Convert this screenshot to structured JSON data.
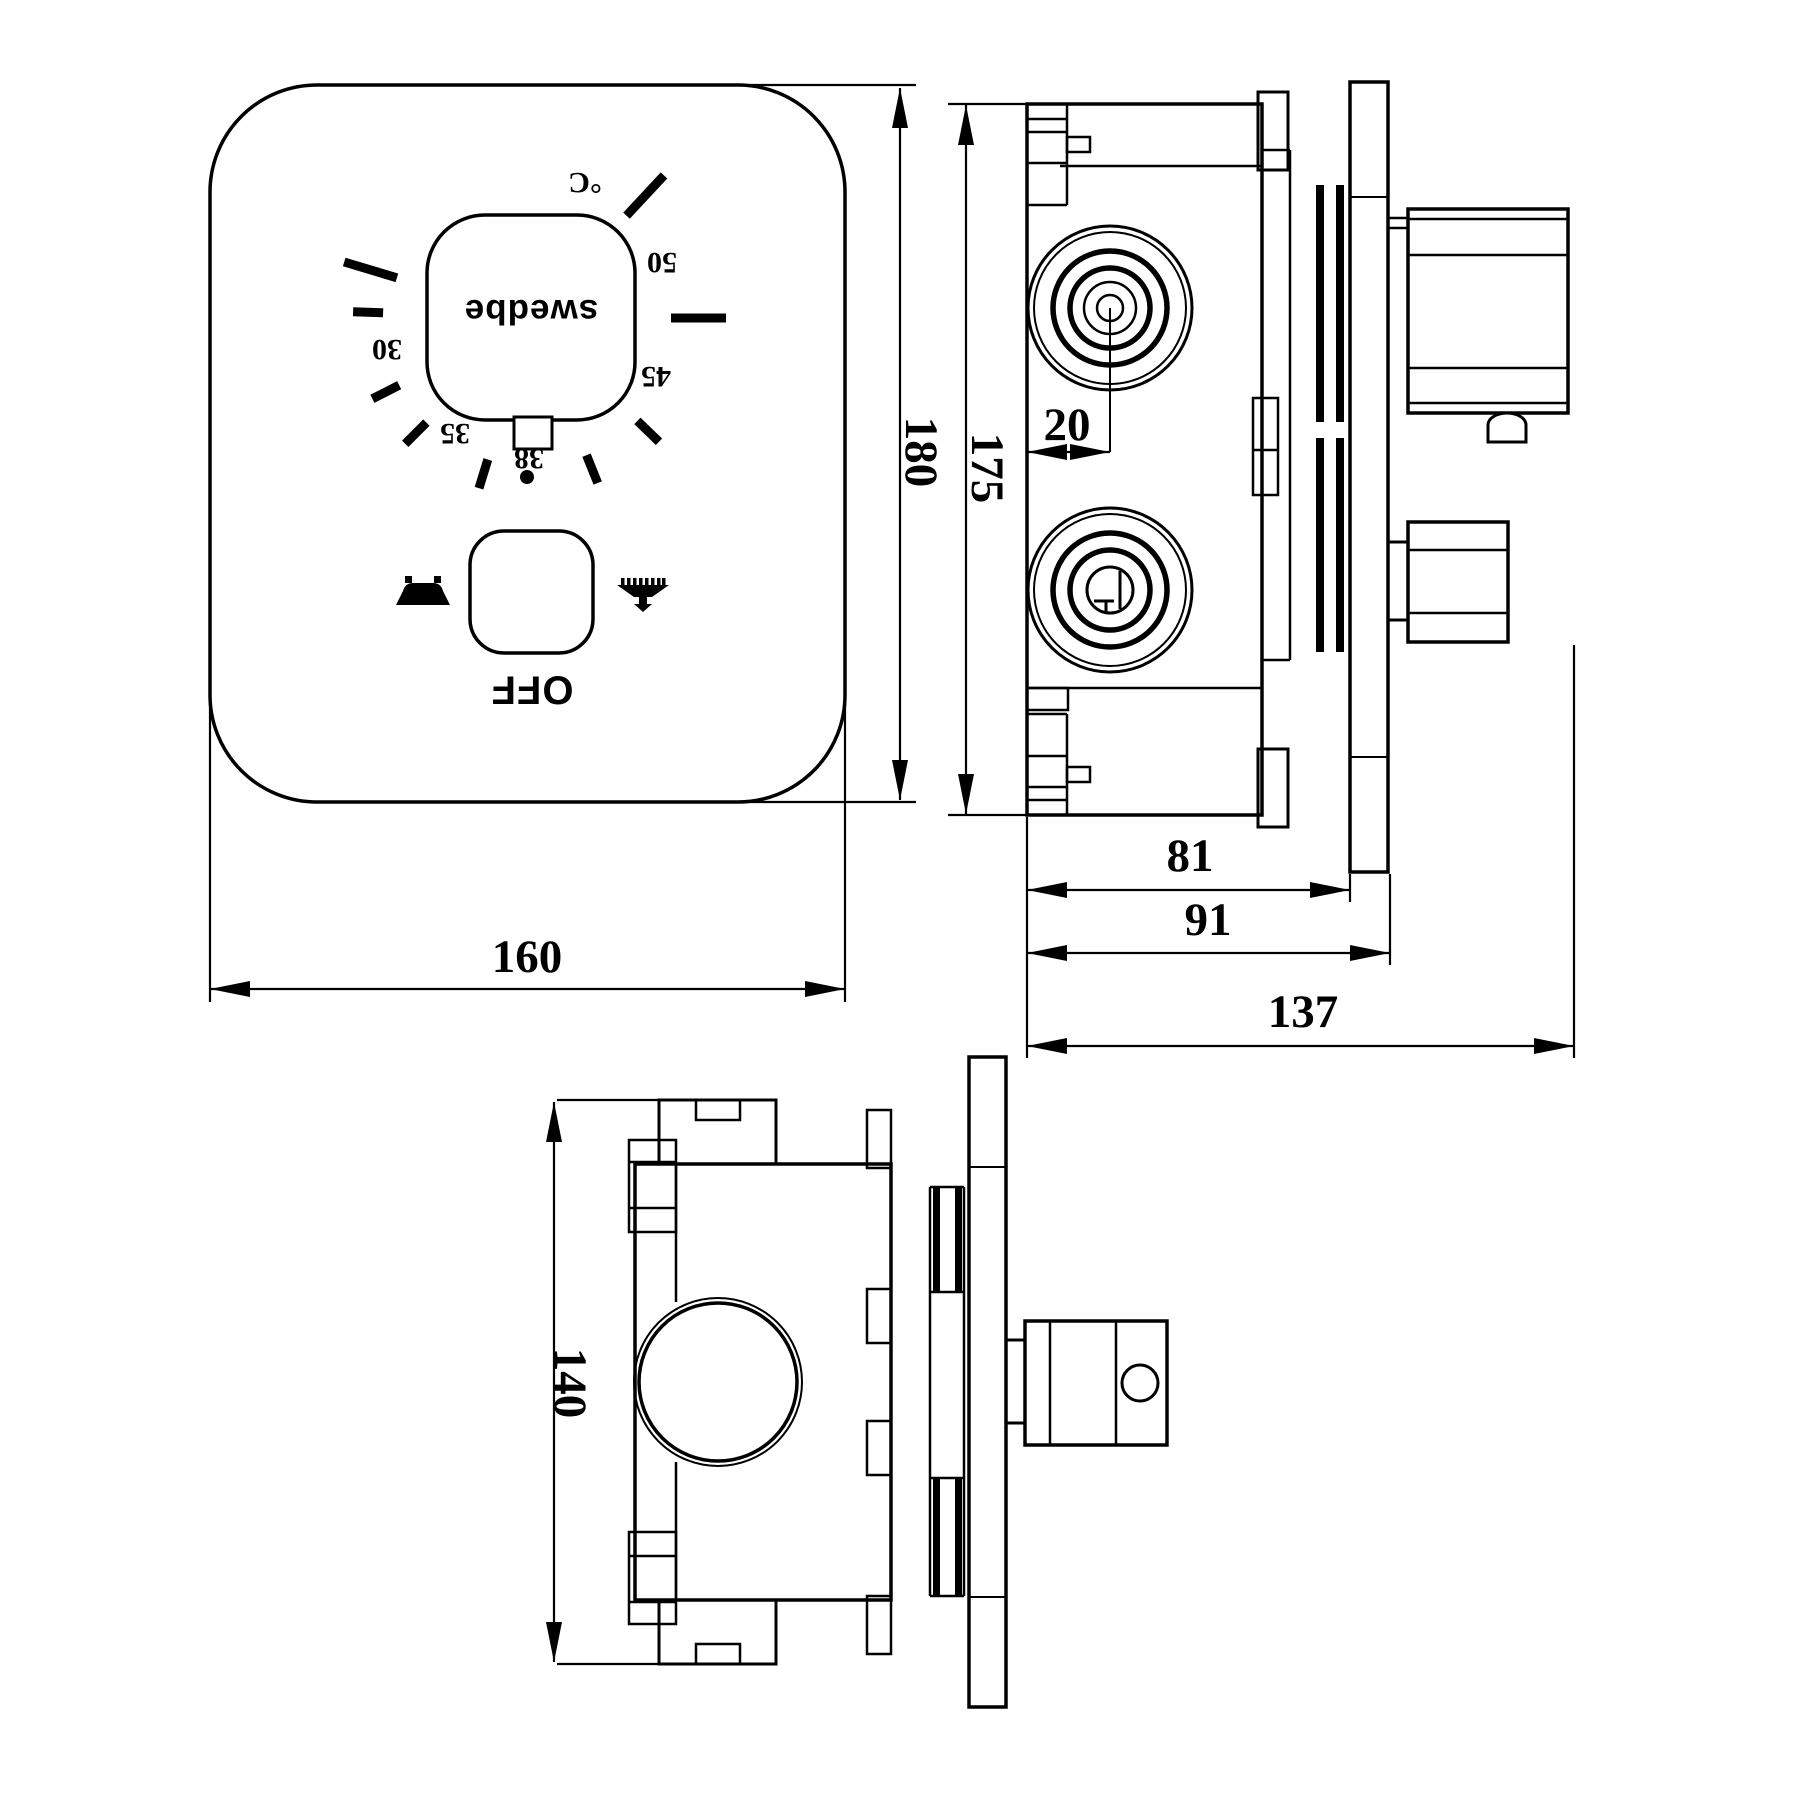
{
  "colors": {
    "line": "#000000",
    "background": "#ffffff"
  },
  "front_view": {
    "brand": "swedbe",
    "off_label": "OFF",
    "dial": {
      "unit": "°C",
      "marks": [
        "30",
        "35",
        "38",
        "45",
        "50"
      ]
    },
    "icons": [
      "bathtub-icon",
      "shower-icon"
    ]
  },
  "dimensions": {
    "plate_width": "160",
    "plate_height": "180",
    "body_height": "175",
    "cartridge_center_offset": "20",
    "body_depth": "81",
    "plate_face_depth": "91",
    "total_depth": "137",
    "body_width": "140"
  }
}
